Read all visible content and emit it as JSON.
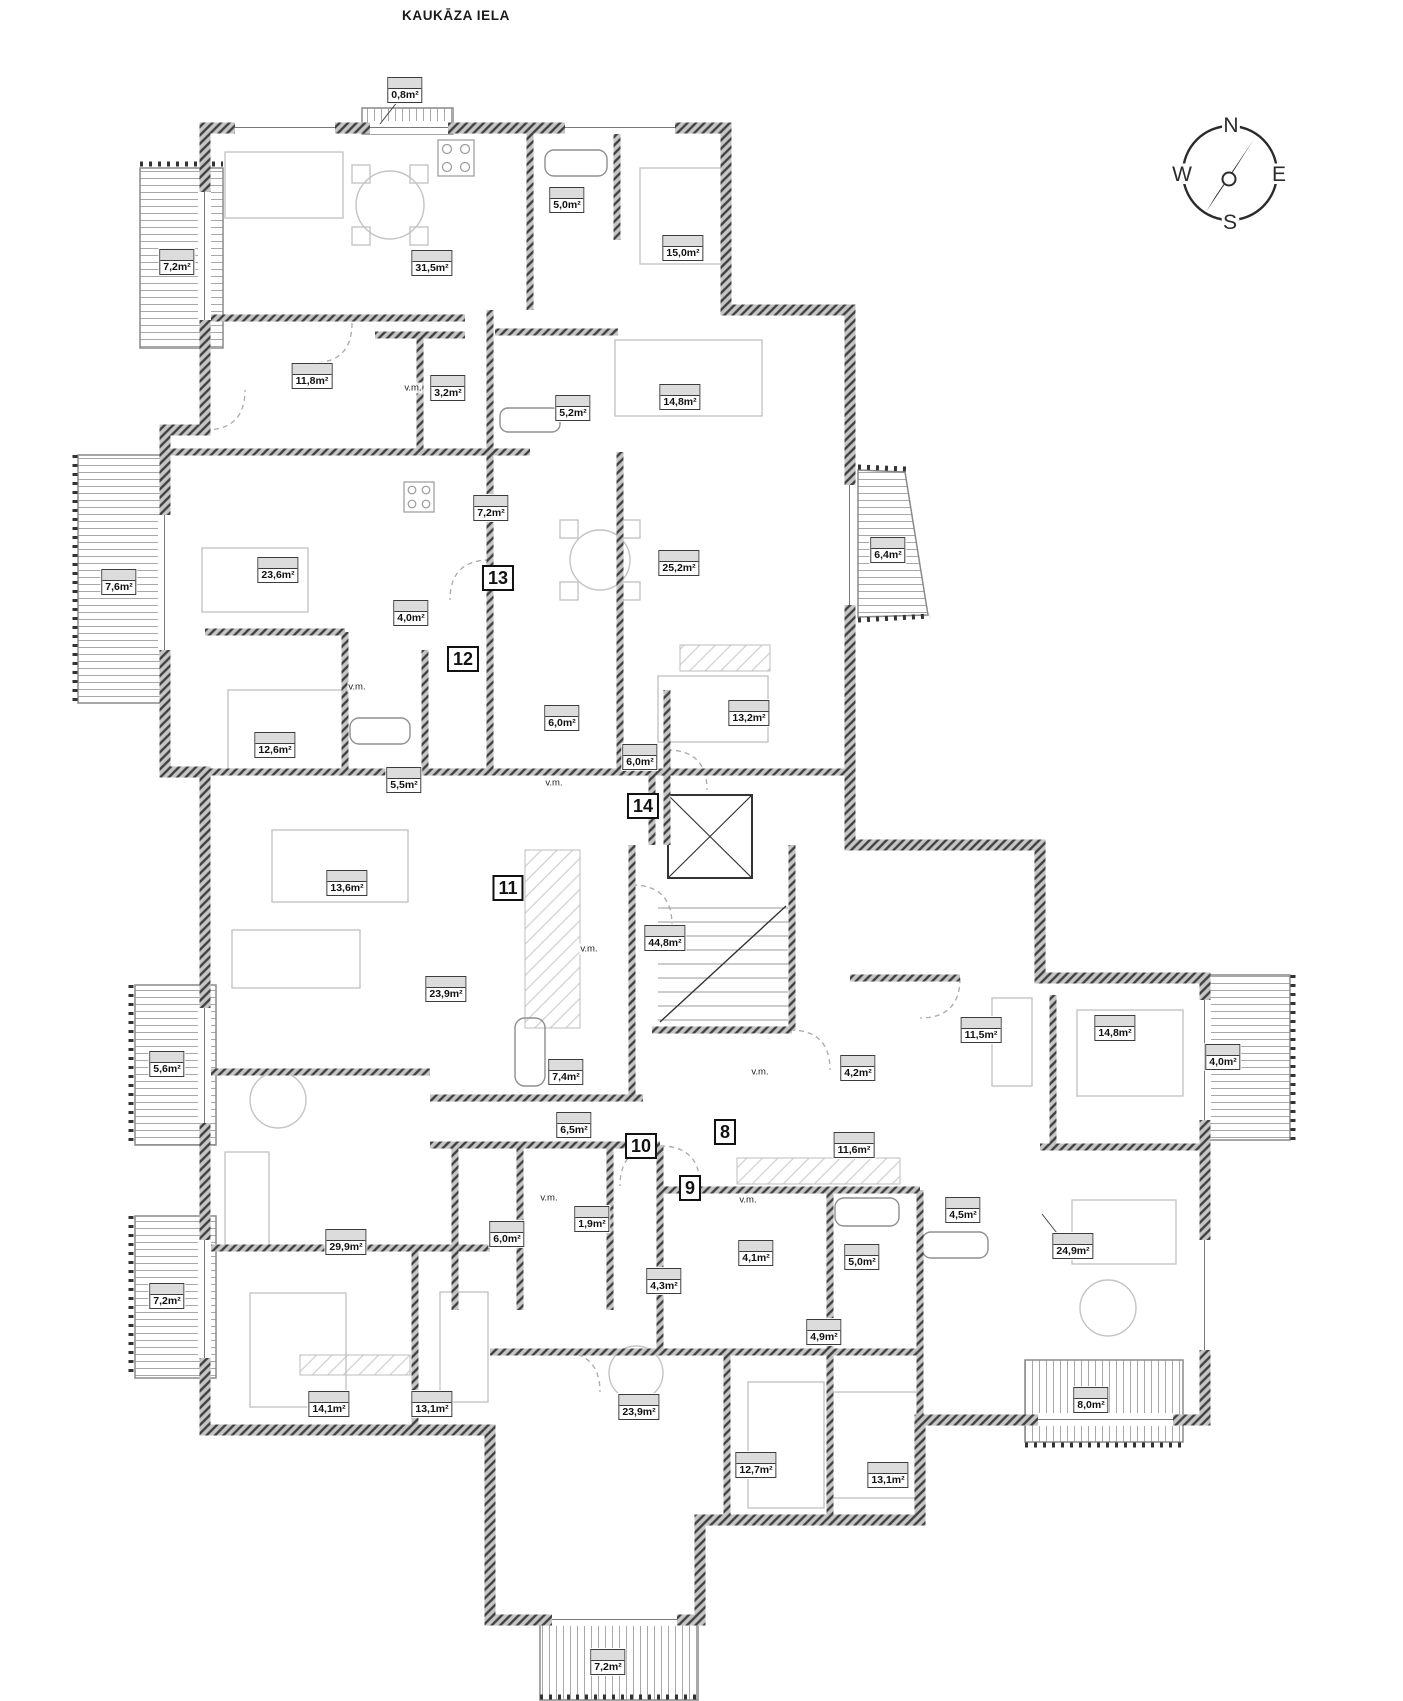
{
  "street_label": "KAUKĀZA IELA",
  "vm_text": "v.m.",
  "compass": {
    "north": "N",
    "east": "E",
    "south": "S",
    "west": "W"
  },
  "colors": {
    "wall": "#404040",
    "area_label_fill": "#dcdcdc",
    "deck_line": "#a8a8a8",
    "furniture": "#c4c4c4",
    "text": "#111111"
  },
  "area_labels": [
    {
      "text": "0,8m²",
      "x": 405,
      "y": 90
    },
    {
      "text": "7,2m²",
      "x": 177,
      "y": 262
    },
    {
      "text": "31,5m²",
      "x": 432,
      "y": 263
    },
    {
      "text": "5,0m²",
      "x": 567,
      "y": 200
    },
    {
      "text": "15,0m²",
      "x": 683,
      "y": 248
    },
    {
      "text": "11,8m²",
      "x": 312,
      "y": 376
    },
    {
      "text": "3,2m²",
      "x": 448,
      "y": 388
    },
    {
      "text": "5,2m²",
      "x": 573,
      "y": 408
    },
    {
      "text": "14,8m²",
      "x": 680,
      "y": 397
    },
    {
      "text": "7,6m²",
      "x": 119,
      "y": 582
    },
    {
      "text": "23,6m²",
      "x": 278,
      "y": 570
    },
    {
      "text": "7,2m²",
      "x": 491,
      "y": 508
    },
    {
      "text": "25,2m²",
      "x": 679,
      "y": 563
    },
    {
      "text": "6,4m²",
      "x": 888,
      "y": 550
    },
    {
      "text": "4,0m²",
      "x": 411,
      "y": 613
    },
    {
      "text": "12,6m²",
      "x": 275,
      "y": 745
    },
    {
      "text": "5,5m²",
      "x": 404,
      "y": 780
    },
    {
      "text": "6,0m²",
      "x": 562,
      "y": 718
    },
    {
      "text": "6,0m²",
      "x": 640,
      "y": 757
    },
    {
      "text": "13,2m²",
      "x": 749,
      "y": 713
    },
    {
      "text": "13,6m²",
      "x": 347,
      "y": 883
    },
    {
      "text": "44,8m²",
      "x": 665,
      "y": 938
    },
    {
      "text": "23,9m²",
      "x": 446,
      "y": 989
    },
    {
      "text": "7,4m²",
      "x": 566,
      "y": 1072
    },
    {
      "text": "6,5m²",
      "x": 574,
      "y": 1125
    },
    {
      "text": "11,5m²",
      "x": 981,
      "y": 1030
    },
    {
      "text": "14,8m²",
      "x": 1115,
      "y": 1028
    },
    {
      "text": "4,2m²",
      "x": 858,
      "y": 1068
    },
    {
      "text": "4,0m²",
      "x": 1223,
      "y": 1057
    },
    {
      "text": "11,6m²",
      "x": 854,
      "y": 1145
    },
    {
      "text": "29,9m²",
      "x": 346,
      "y": 1242
    },
    {
      "text": "5,6m²",
      "x": 167,
      "y": 1064
    },
    {
      "text": "7,2m²",
      "x": 167,
      "y": 1296
    },
    {
      "text": "6,0m²",
      "x": 507,
      "y": 1234
    },
    {
      "text": "1,9m²",
      "x": 592,
      "y": 1219
    },
    {
      "text": "4,1m²",
      "x": 756,
      "y": 1253
    },
    {
      "text": "5,0m²",
      "x": 862,
      "y": 1257
    },
    {
      "text": "4,5m²",
      "x": 963,
      "y": 1210
    },
    {
      "text": "24,9m²",
      "x": 1073,
      "y": 1246
    },
    {
      "text": "4,3m²",
      "x": 664,
      "y": 1281
    },
    {
      "text": "4,9m²",
      "x": 824,
      "y": 1332
    },
    {
      "text": "14,1m²",
      "x": 329,
      "y": 1404
    },
    {
      "text": "13,1m²",
      "x": 432,
      "y": 1404
    },
    {
      "text": "23,9m²",
      "x": 639,
      "y": 1407
    },
    {
      "text": "12,7m²",
      "x": 756,
      "y": 1465
    },
    {
      "text": "13,1m²",
      "x": 888,
      "y": 1475
    },
    {
      "text": "8,0m²",
      "x": 1091,
      "y": 1400
    },
    {
      "text": "7,2m²",
      "x": 608,
      "y": 1662
    }
  ],
  "apartment_numbers": [
    {
      "text": "13",
      "x": 498,
      "y": 578
    },
    {
      "text": "12",
      "x": 463,
      "y": 659
    },
    {
      "text": "14",
      "x": 643,
      "y": 806
    },
    {
      "text": "11",
      "x": 508,
      "y": 888
    },
    {
      "text": "10",
      "x": 641,
      "y": 1146
    },
    {
      "text": "8",
      "x": 725,
      "y": 1132
    },
    {
      "text": "9",
      "x": 690,
      "y": 1188
    }
  ],
  "vm_positions": [
    {
      "x": 413,
      "y": 388
    },
    {
      "x": 357,
      "y": 687
    },
    {
      "x": 554,
      "y": 783
    },
    {
      "x": 589,
      "y": 949
    },
    {
      "x": 760,
      "y": 1072
    },
    {
      "x": 549,
      "y": 1198
    },
    {
      "x": 748,
      "y": 1200
    }
  ]
}
